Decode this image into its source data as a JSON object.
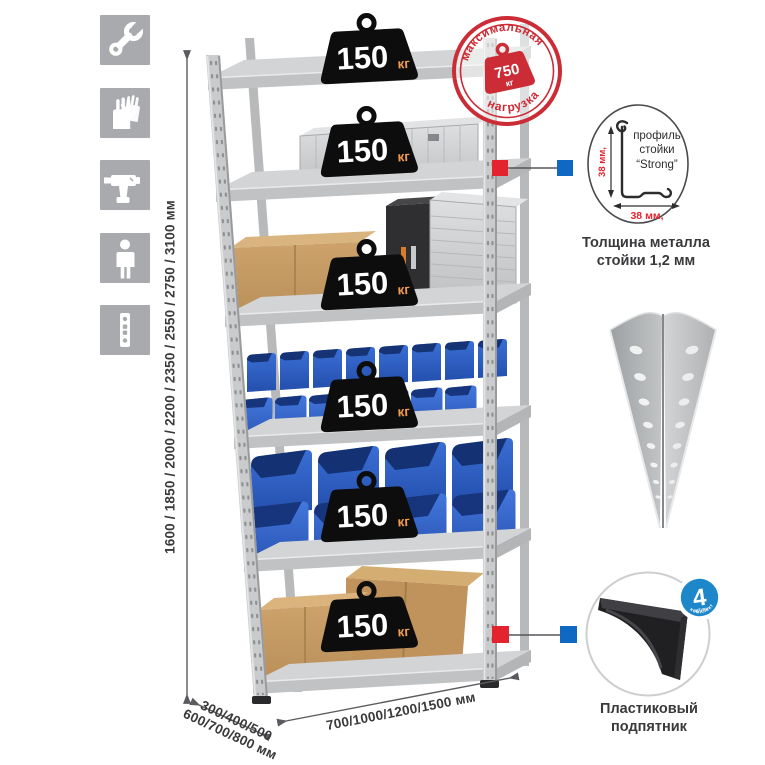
{
  "left_icons": [
    {
      "name": "wrench-icon"
    },
    {
      "name": "gloves-icon"
    },
    {
      "name": "drill-icon"
    },
    {
      "name": "person-icon"
    },
    {
      "name": "rack-post-icon"
    }
  ],
  "dimensions": {
    "height_label": "1600 / 1850 / 2000 / 2200 / 2350 / 2550 / 2750 / 3100 мм",
    "depth_line1": "300/400/500",
    "depth_line2": "600/700/800 мм",
    "width_label": "700/1000/1200/1500 мм"
  },
  "max_load_stamp": {
    "arc_top": "максимальная",
    "arc_bottom": "нагрузка",
    "value": "750",
    "unit": "кг"
  },
  "shelf_badge": {
    "value": "150",
    "unit": "кг",
    "count": 6
  },
  "profile_detail": {
    "label_line1": "профиль",
    "label_line2": "стойки",
    "label_line3": "“Strong”",
    "dim_vertical": "38 мм,",
    "dim_horizontal": "38 мм,",
    "caption_line1": "Толщина металла",
    "caption_line2": "стойки 1,2 мм"
  },
  "foot_detail": {
    "badge_value": "4",
    "badge_qty": "штуки",
    "badge_arc": "в комплекте",
    "caption_line1": "Пластиковый",
    "caption_line2": "подпятник"
  },
  "colors": {
    "stamp_red": "#cb2c35",
    "marker_red": "#e3242e",
    "marker_blue": "#0f68c2",
    "badge_blue": "#1d87c9",
    "bin_blue": "#2f63c9",
    "weight_black": "#0d0d0d",
    "unit_orange": "#f29b4d",
    "icon_gray": "#a8aaad"
  }
}
